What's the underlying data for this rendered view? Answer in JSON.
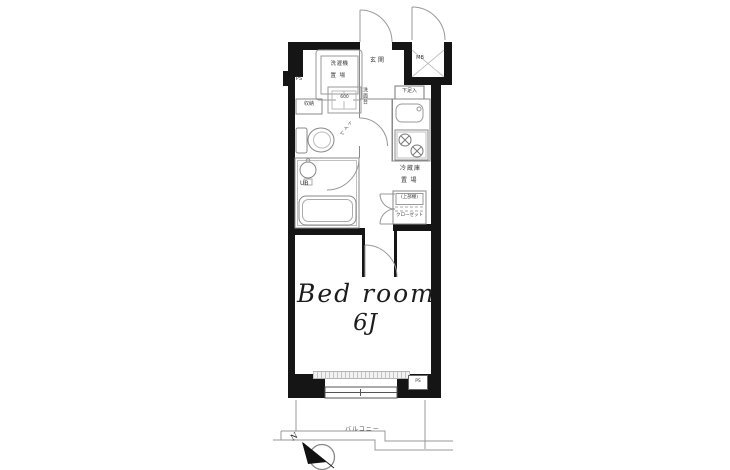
{
  "floorplan": {
    "rooms": {
      "bedroom_name": "Bed room",
      "bedroom_size": "6J",
      "entrance": "玄関",
      "balcony": "バルコニー",
      "unit_bath": "UB"
    },
    "fixtures": {
      "washer_line1": "洗濯機",
      "washer_line2": "置場",
      "storage": "収納",
      "vanity": "洗面台",
      "vanity_width": "600",
      "toilet": "トイレ",
      "shoe_cabinet": "下足入",
      "fridge_line1": "冷蔵庫",
      "fridge_line2": "置場",
      "upper_shelf": "(上部棚)",
      "closet": "クローゼット"
    },
    "service": {
      "pipe_space_top": "PS",
      "pipe_space_bottom": "PS",
      "meter_box": "MB"
    },
    "compass": {
      "north": "N"
    },
    "colors": {
      "wall": "#151515",
      "line": "#8a8a8a",
      "text": "#3a3a3a"
    }
  }
}
